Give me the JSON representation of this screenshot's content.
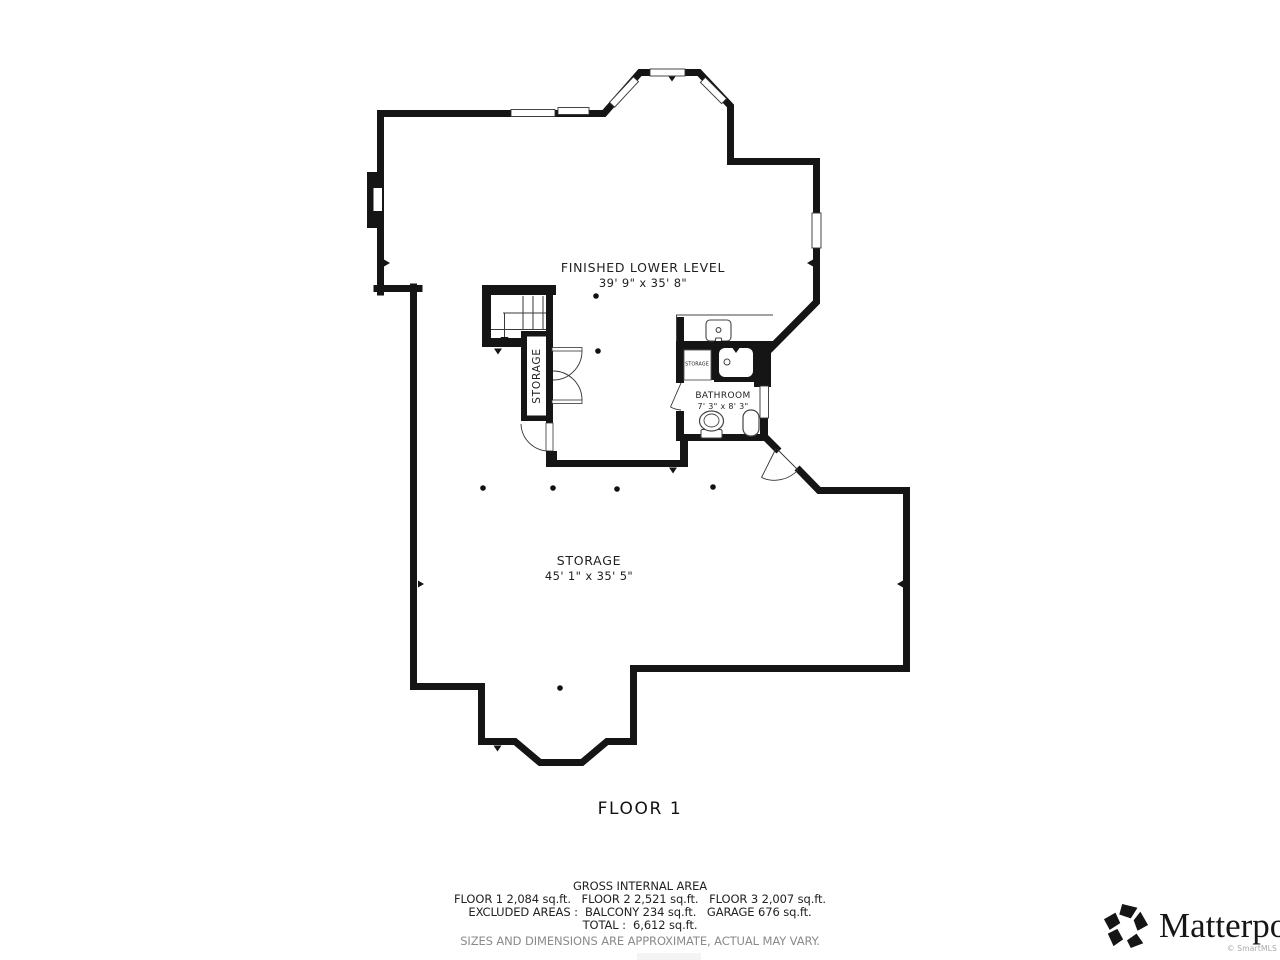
{
  "floor_plan": {
    "floor_title": "FLOOR 1",
    "rooms": {
      "finished_lower_level": {
        "name": "FINISHED LOWER LEVEL",
        "dims": "39' 9\" x 35' 8\""
      },
      "storage_main": {
        "name": "STORAGE",
        "dims": "45' 1\" x 35' 5\""
      },
      "bathroom": {
        "name": "BATHROOM",
        "dims": "7' 3\" x 8' 3\""
      },
      "storage_closet": {
        "name": "STORAGE"
      },
      "storage_closet_small": {
        "name": "STORAGE"
      }
    }
  },
  "footer": {
    "gross_title": "GROSS INTERNAL AREA",
    "line_floors": "FLOOR 1 2,084 sq.ft.   FLOOR 2 2,521 sq.ft.   FLOOR 3 2,007 sq.ft.",
    "line_excluded": "EXCLUDED AREAS :  BALCONY 234 sq.ft.   GARAGE 676 sq.ft.",
    "line_total": "TOTAL :  6,612 sq.ft.",
    "disclaimer": "SIZES AND DIMENSIONS ARE APPROXIMATE, ACTUAL MAY VARY."
  },
  "branding": {
    "logo_text": "Matterport",
    "copyright": "© SmartMLS"
  },
  "colors": {
    "wall": "#151515",
    "text": "#1f1f1f",
    "muted": "#8a8a8a"
  }
}
